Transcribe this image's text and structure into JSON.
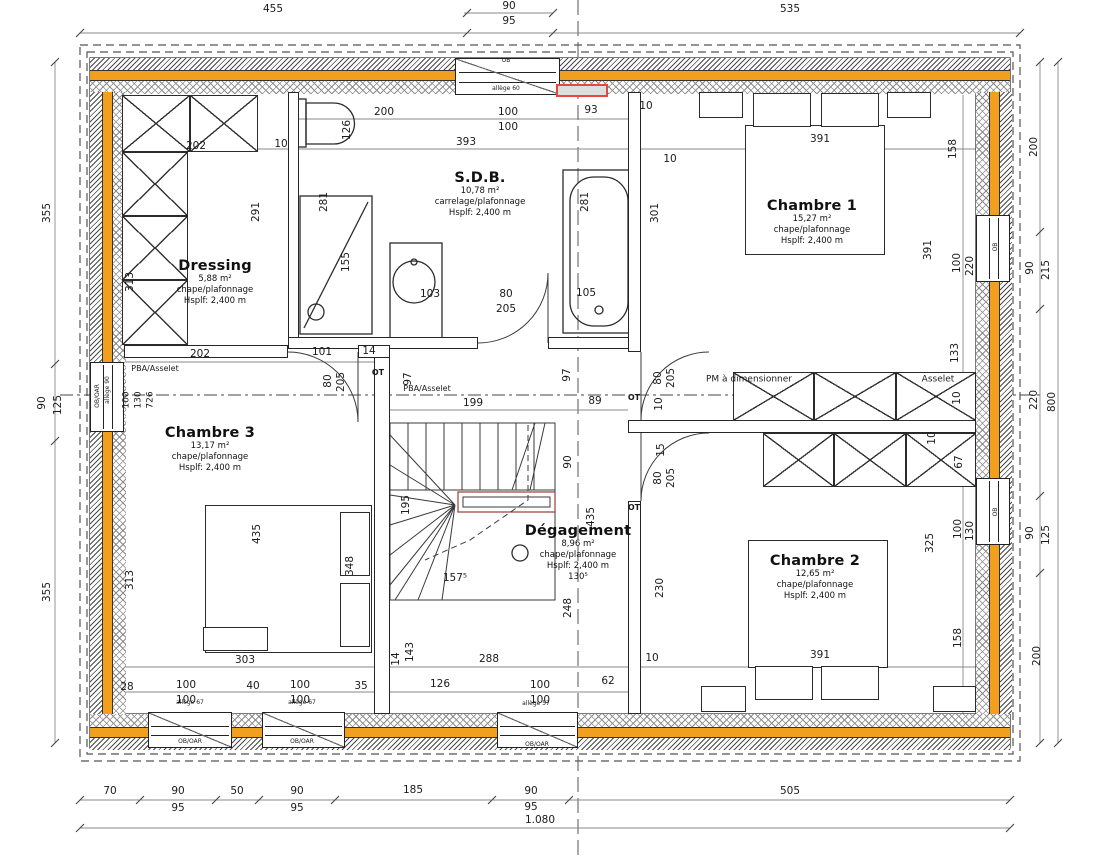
{
  "colors": {
    "insulation_orange": "#F0A01E",
    "highlight_red": "#E8453C",
    "wall_line": "#2b2b2b",
    "dim_line": "#8a8a8a"
  },
  "rooms": [
    {
      "name": "Dressing",
      "area": "5,88 m²",
      "finish": "chape/plafonnage",
      "height": "Hsplf: 2,400 m",
      "extra": "",
      "x": 215,
      "y": 258
    },
    {
      "name": "S.D.B.",
      "area": "10,78 m²",
      "finish": "carrelage/plafonnage",
      "height": "Hsplf: 2,400 m",
      "extra": "",
      "x": 480,
      "y": 170
    },
    {
      "name": "Chambre 1",
      "area": "15,27 m²",
      "finish": "chape/plafonnage",
      "height": "Hsplf: 2,400 m",
      "extra": "",
      "x": 812,
      "y": 198
    },
    {
      "name": "Chambre 3",
      "area": "13,17 m²",
      "finish": "chape/plafonnage",
      "height": "Hsplf: 2,400 m",
      "extra": "",
      "x": 210,
      "y": 425
    },
    {
      "name": "Dégagement",
      "area": "8,96 m²",
      "finish": "chape/plafonnage",
      "height": "Hsplf: 2,400 m",
      "extra": "130⁵",
      "x": 578,
      "y": 523
    },
    {
      "name": "Chambre 2",
      "area": "12,65 m²",
      "finish": "chape/plafonnage",
      "height": "Hsplf: 2,400 m",
      "extra": "",
      "x": 815,
      "y": 553
    }
  ],
  "labels": [
    {
      "t": "455",
      "x": 273,
      "y": 9
    },
    {
      "t": "90",
      "x": 509,
      "y": 6
    },
    {
      "t": "95",
      "x": 509,
      "y": 21
    },
    {
      "t": "535",
      "x": 790,
      "y": 9
    },
    {
      "t": "70",
      "x": 110,
      "y": 791
    },
    {
      "t": "90",
      "x": 178,
      "y": 791
    },
    {
      "t": "95",
      "x": 178,
      "y": 808
    },
    {
      "t": "50",
      "x": 237,
      "y": 791
    },
    {
      "t": "90",
      "x": 297,
      "y": 791
    },
    {
      "t": "95",
      "x": 297,
      "y": 808
    },
    {
      "t": "185",
      "x": 413,
      "y": 790
    },
    {
      "t": "90",
      "x": 531,
      "y": 791
    },
    {
      "t": "95",
      "x": 531,
      "y": 807
    },
    {
      "t": "505",
      "x": 790,
      "y": 791
    },
    {
      "t": "1.080",
      "x": 540,
      "y": 820
    },
    {
      "t": "355",
      "x": 47,
      "y": 213,
      "r": 1
    },
    {
      "t": "90",
      "x": 42,
      "y": 403,
      "r": 1
    },
    {
      "t": "125",
      "x": 58,
      "y": 405,
      "r": 1
    },
    {
      "t": "355",
      "x": 47,
      "y": 592,
      "r": 1
    },
    {
      "t": "200",
      "x": 1034,
      "y": 147,
      "r": 1
    },
    {
      "t": "90",
      "x": 1030,
      "y": 268,
      "r": 1
    },
    {
      "t": "215",
      "x": 1046,
      "y": 270,
      "r": 1
    },
    {
      "t": "220",
      "x": 1034,
      "y": 400,
      "r": 1
    },
    {
      "t": "800",
      "x": 1052,
      "y": 402,
      "r": 1
    },
    {
      "t": "90",
      "x": 1030,
      "y": 533,
      "r": 1
    },
    {
      "t": "125",
      "x": 1046,
      "y": 535,
      "r": 1
    },
    {
      "t": "200",
      "x": 1037,
      "y": 656,
      "r": 1
    },
    {
      "t": "200",
      "x": 384,
      "y": 112
    },
    {
      "t": "100",
      "x": 508,
      "y": 112
    },
    {
      "t": "100",
      "x": 508,
      "y": 127
    },
    {
      "t": "93",
      "x": 591,
      "y": 110
    },
    {
      "t": "10",
      "x": 646,
      "y": 106
    },
    {
      "t": "202",
      "x": 196,
      "y": 146
    },
    {
      "t": "10",
      "x": 281,
      "y": 144
    },
    {
      "t": "126",
      "x": 347,
      "y": 130,
      "r": 1
    },
    {
      "t": "393",
      "x": 466,
      "y": 142
    },
    {
      "t": "10",
      "x": 670,
      "y": 159
    },
    {
      "t": "391",
      "x": 820,
      "y": 139
    },
    {
      "t": "158",
      "x": 953,
      "y": 149,
      "r": 1
    },
    {
      "t": "313",
      "x": 130,
      "y": 282,
      "r": 1
    },
    {
      "t": "291",
      "x": 256,
      "y": 212,
      "r": 1
    },
    {
      "t": "281",
      "x": 324,
      "y": 202,
      "r": 1
    },
    {
      "t": "155",
      "x": 346,
      "y": 262,
      "r": 1
    },
    {
      "t": "103",
      "x": 430,
      "y": 294
    },
    {
      "t": "80",
      "x": 506,
      "y": 294
    },
    {
      "t": "205",
      "x": 506,
      "y": 309
    },
    {
      "t": "105",
      "x": 586,
      "y": 293
    },
    {
      "t": "281",
      "x": 585,
      "y": 202,
      "r": 1
    },
    {
      "t": "301",
      "x": 655,
      "y": 213,
      "r": 1
    },
    {
      "t": "391",
      "x": 928,
      "y": 250,
      "r": 1
    },
    {
      "t": "100",
      "x": 957,
      "y": 263,
      "r": 1
    },
    {
      "t": "220",
      "x": 970,
      "y": 266,
      "r": 1
    },
    {
      "t": "133",
      "x": 955,
      "y": 353,
      "r": 1
    },
    {
      "t": "PBA/Asselet",
      "x": 155,
      "y": 369,
      "s": 8
    },
    {
      "t": "202",
      "x": 200,
      "y": 354
    },
    {
      "t": "101",
      "x": 322,
      "y": 352
    },
    {
      "t": "14",
      "x": 369,
      "y": 351
    },
    {
      "t": "80",
      "x": 328,
      "y": 381,
      "r": 1
    },
    {
      "t": "205",
      "x": 341,
      "y": 382,
      "r": 1
    },
    {
      "t": "OT",
      "x": 378,
      "y": 373,
      "s": 8,
      "b": 1
    },
    {
      "t": "allège 90",
      "x": 108,
      "y": 390,
      "r": 1,
      "s": 6
    },
    {
      "t": "100",
      "x": 127,
      "y": 400,
      "r": 1,
      "s": 9
    },
    {
      "t": "130",
      "x": 139,
      "y": 400,
      "r": 1,
      "s": 9
    },
    {
      "t": "726",
      "x": 151,
      "y": 400,
      "r": 1,
      "s": 9
    },
    {
      "t": "PBA/Asselet",
      "x": 427,
      "y": 389,
      "s": 8
    },
    {
      "t": "97",
      "x": 408,
      "y": 379,
      "r": 1
    },
    {
      "t": "97",
      "x": 567,
      "y": 375,
      "r": 1
    },
    {
      "t": "199",
      "x": 473,
      "y": 403
    },
    {
      "t": "89",
      "x": 595,
      "y": 401
    },
    {
      "t": "PM à dimensionner",
      "x": 749,
      "y": 380,
      "s": 9
    },
    {
      "t": "Asselet",
      "x": 938,
      "y": 380,
      "s": 9
    },
    {
      "t": "80",
      "x": 658,
      "y": 378,
      "r": 1
    },
    {
      "t": "205",
      "x": 671,
      "y": 378,
      "r": 1
    },
    {
      "t": "10",
      "x": 659,
      "y": 404,
      "r": 1
    },
    {
      "t": "10",
      "x": 957,
      "y": 398,
      "r": 1
    },
    {
      "t": "10",
      "x": 932,
      "y": 438,
      "r": 1
    },
    {
      "t": "15",
      "x": 661,
      "y": 450,
      "r": 1
    },
    {
      "t": "80",
      "x": 658,
      "y": 478,
      "r": 1
    },
    {
      "t": "205",
      "x": 671,
      "y": 478,
      "r": 1
    },
    {
      "t": "67",
      "x": 959,
      "y": 462,
      "r": 1
    },
    {
      "t": "OT",
      "x": 634,
      "y": 398,
      "s": 8,
      "b": 1
    },
    {
      "t": "OT",
      "x": 634,
      "y": 508,
      "s": 8,
      "b": 1
    },
    {
      "t": "195",
      "x": 406,
      "y": 505,
      "r": 1
    },
    {
      "t": "90",
      "x": 568,
      "y": 462,
      "r": 1
    },
    {
      "t": "435",
      "x": 591,
      "y": 517,
      "r": 1
    },
    {
      "t": "157⁵",
      "x": 455,
      "y": 578
    },
    {
      "t": "248",
      "x": 568,
      "y": 608,
      "r": 1
    },
    {
      "t": "230",
      "x": 660,
      "y": 588,
      "r": 1
    },
    {
      "t": "435",
      "x": 257,
      "y": 534,
      "r": 1
    },
    {
      "t": "313",
      "x": 130,
      "y": 580,
      "r": 1
    },
    {
      "t": "348",
      "x": 350,
      "y": 566,
      "r": 1
    },
    {
      "t": "303",
      "x": 245,
      "y": 660
    },
    {
      "t": "14",
      "x": 396,
      "y": 659,
      "r": 1
    },
    {
      "t": "143",
      "x": 410,
      "y": 652,
      "r": 1
    },
    {
      "t": "28",
      "x": 127,
      "y": 687
    },
    {
      "t": "100",
      "x": 186,
      "y": 685
    },
    {
      "t": "100",
      "x": 186,
      "y": 700
    },
    {
      "t": "40",
      "x": 253,
      "y": 686
    },
    {
      "t": "100",
      "x": 300,
      "y": 685
    },
    {
      "t": "100",
      "x": 300,
      "y": 700
    },
    {
      "t": "35",
      "x": 361,
      "y": 686
    },
    {
      "t": "288",
      "x": 489,
      "y": 659
    },
    {
      "t": "10",
      "x": 652,
      "y": 658
    },
    {
      "t": "126",
      "x": 440,
      "y": 684
    },
    {
      "t": "100",
      "x": 540,
      "y": 685
    },
    {
      "t": "100",
      "x": 540,
      "y": 700
    },
    {
      "t": "62",
      "x": 608,
      "y": 681
    },
    {
      "t": "391",
      "x": 820,
      "y": 655
    },
    {
      "t": "325",
      "x": 930,
      "y": 543,
      "r": 1
    },
    {
      "t": "100",
      "x": 958,
      "y": 529,
      "r": 1
    },
    {
      "t": "130",
      "x": 970,
      "y": 531,
      "r": 1
    },
    {
      "t": "158",
      "x": 958,
      "y": 638,
      "r": 1
    },
    {
      "t": "OB",
      "x": 506,
      "y": 61,
      "s": 6
    },
    {
      "t": "allège 60",
      "x": 506,
      "y": 89,
      "s": 6
    },
    {
      "t": "allège 67",
      "x": 190,
      "y": 703,
      "s": 6
    },
    {
      "t": "allège 67",
      "x": 302,
      "y": 703,
      "s": 6
    },
    {
      "t": "allège 57",
      "x": 536,
      "y": 704,
      "s": 6
    },
    {
      "t": "OB/OAR",
      "x": 190,
      "y": 742,
      "s": 6
    },
    {
      "t": "OB/OAR",
      "x": 302,
      "y": 742,
      "s": 6
    },
    {
      "t": "OB/OAR",
      "x": 537,
      "y": 745,
      "s": 6
    },
    {
      "t": "OB/OAR",
      "x": 98,
      "y": 396,
      "r": 1,
      "s": 6
    },
    {
      "t": "OB",
      "x": 996,
      "y": 247,
      "r": 1,
      "s": 6
    },
    {
      "t": "OB",
      "x": 996,
      "y": 512,
      "r": 1,
      "s": 6
    }
  ]
}
